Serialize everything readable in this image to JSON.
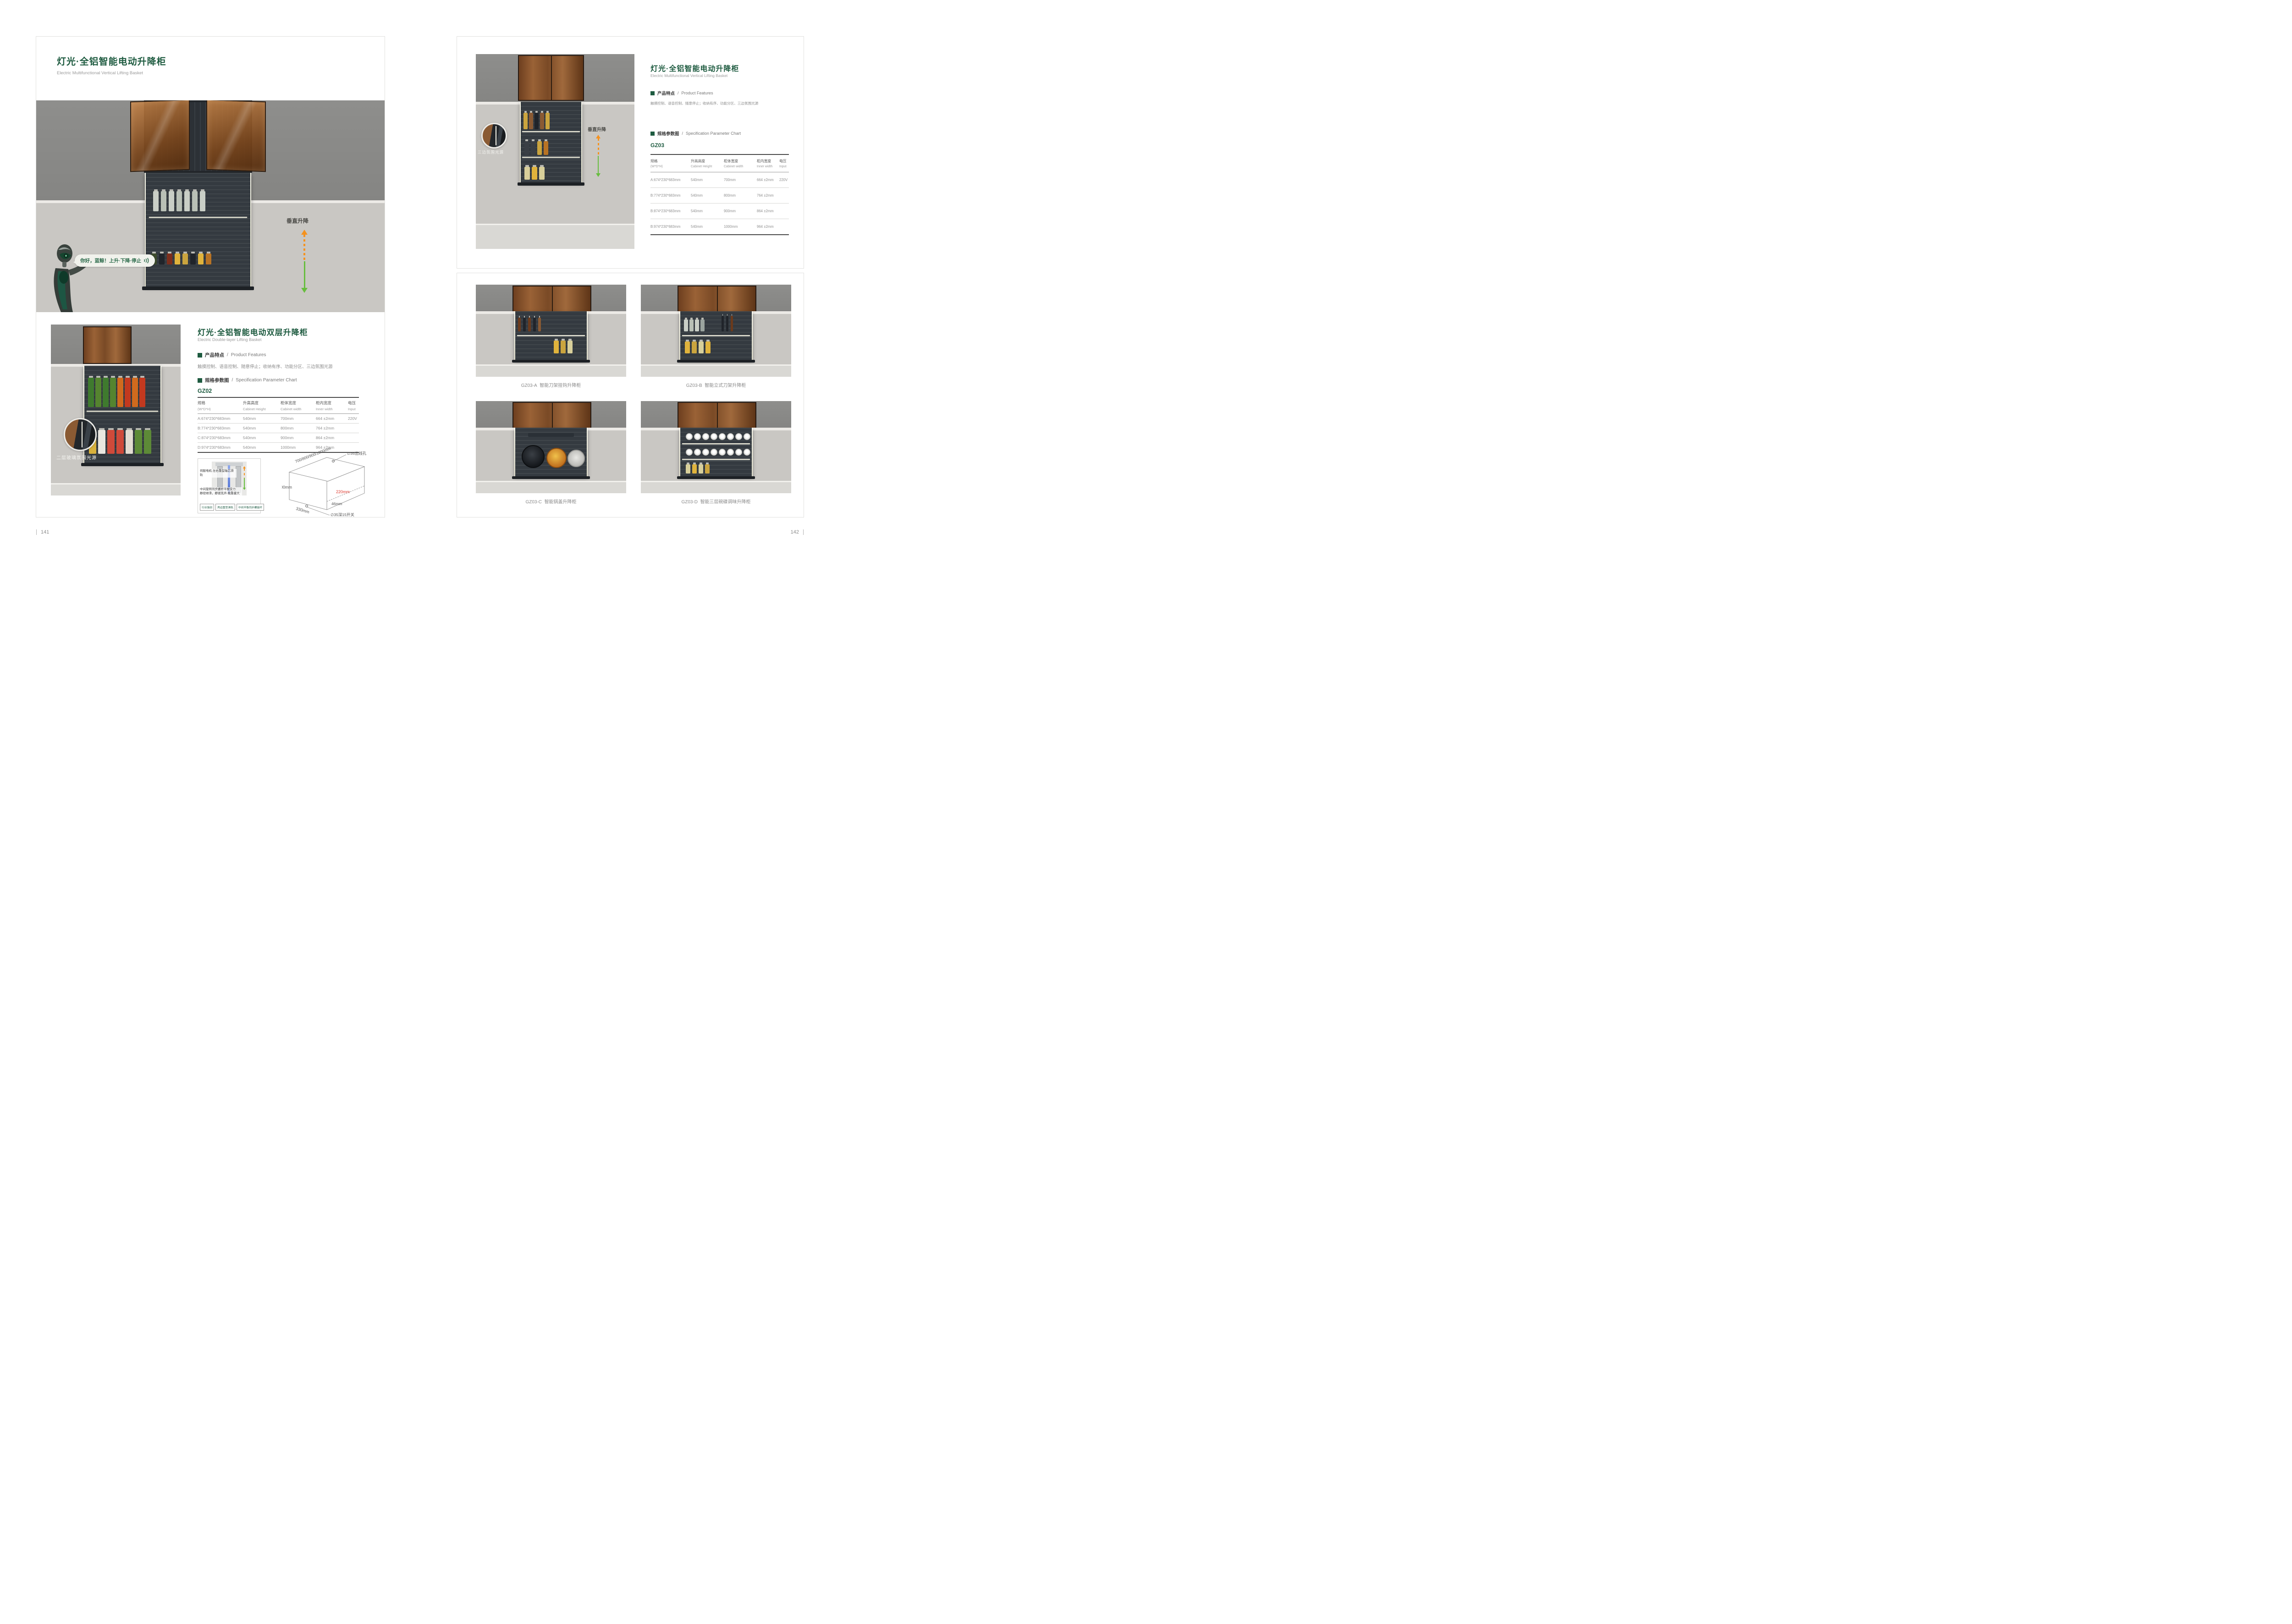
{
  "colors": {
    "accent_green": "#1e5b40",
    "arrow_orange": "#f5921e",
    "arrow_green": "#67bd3e",
    "dim_red": "#e03a2f"
  },
  "shared": {
    "title_zh": "灯光·全铝智能电动升降柜",
    "title_en": "Electric Multifunctional Vertical Lifting Basket",
    "features_label_zh": "产品特点",
    "features_label_sep": "/",
    "features_label_en": "Product Features",
    "features_text": "触摸控制、语音控制、随意停止；收纳有序、功能分区、三边氛围光源",
    "spec_label_zh": "规格参数图",
    "spec_label_sep": "/",
    "spec_label_en": "Specification Parameter Chart",
    "table_headers": [
      {
        "zh": "规格",
        "en": "(W*D*H)"
      },
      {
        "zh": "升高高度",
        "en": "Cabinet Height"
      },
      {
        "zh": "柜体宽度",
        "en": "Cabinet width"
      },
      {
        "zh": "柜内宽度",
        "en": "Inner width"
      },
      {
        "zh": "电压",
        "en": "Input"
      }
    ]
  },
  "left_page": {
    "page_number": "141",
    "hero": {
      "bubble_text": "你好，蓝鲸！上升·下降·停止",
      "lift_label": "垂直升降"
    },
    "section": {
      "title_zh": "灯光·全铝智能电动双层升降柜",
      "title_en": "Electric Double-layer Lifting Basket",
      "model": "GZ02",
      "callout": "二层玻璃氛围光源"
    },
    "table_rows": [
      [
        "A:674*230*683mm",
        "540mm",
        "700mm",
        "664 ±2mm",
        "220V"
      ],
      [
        "B:774*230*683mm",
        "540mm",
        "800mm",
        "764 ±2mm",
        ""
      ],
      [
        "C:874*230*683mm",
        "540mm",
        "900mm",
        "864 ±2mm",
        ""
      ],
      [
        "D:974*230*683mm",
        "540mm",
        "1000mm",
        "964 ±2mm",
        ""
      ]
    ],
    "diagram": {
      "note1": "伺服电机·左右重型轴芯滑轨",
      "note2_line1": "中间旋转同步螺杆平衡受力",
      "note2_line2": "静密顺滑，静谧无声·载重量大",
      "tags": [
        "行业独创",
        "两边重型滑轨",
        "中间平衡同步螺旋杆"
      ]
    },
    "iso": {
      "dim_top": "700/800/900/1000mm",
      "dim_height": "700mm",
      "dim_depth": "330mm",
      "dim_inner": "220mm",
      "dim_offset": "46mm",
      "hole_label": "∅35出线孔",
      "switch_label": "∅35深15开关"
    }
  },
  "right_page": {
    "page_number": "142",
    "model": "GZ03",
    "callout": "三边氛围光源",
    "lift_label": "垂直升降",
    "table_rows": [
      [
        "A:674*230*683mm",
        "540mm",
        "700mm",
        "664 ±2mm",
        "220V"
      ],
      [
        "B:774*230*683mm",
        "540mm",
        "800mm",
        "764 ±2mm",
        ""
      ],
      [
        "B:874*230*683mm",
        "540mm",
        "900mm",
        "864 ±2mm",
        ""
      ],
      [
        "B:974*230*683mm",
        "540mm",
        "1000mm",
        "964 ±2mm",
        ""
      ]
    ],
    "products": [
      {
        "code": "GZ03-A",
        "name": "智能刀架挂钩升降柜"
      },
      {
        "code": "GZ03-B",
        "name": "智能立式刀架升降柜"
      },
      {
        "code": "GZ03-C",
        "name": "智能锅盖升降柜"
      },
      {
        "code": "GZ03-D",
        "name": "智能三层碗碟调味升降柜"
      }
    ]
  }
}
